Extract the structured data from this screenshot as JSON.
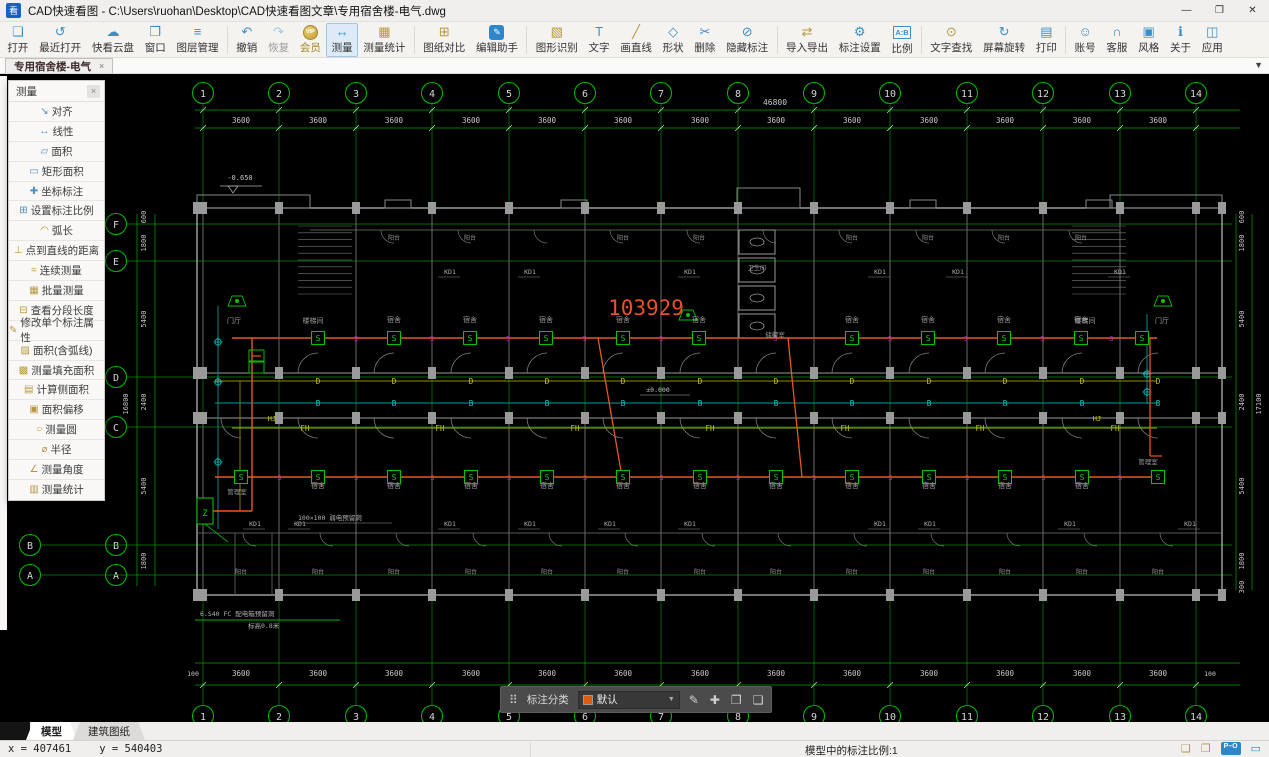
{
  "window": {
    "title": "CAD快速看图 - C:\\Users\\ruohan\\Desktop\\CAD快速看图文章\\专用宿舍楼-电气.dwg",
    "logo_glyph": "看",
    "minimize_glyph": "—",
    "restore_glyph": "❐",
    "close_glyph": "✕"
  },
  "toolbar": {
    "groups": [
      {
        "items": [
          {
            "name": "open",
            "label": "打开",
            "icon": "❏",
            "style": "blue"
          },
          {
            "name": "recent-open",
            "label": "最近打开",
            "icon": "↺",
            "style": "blue"
          },
          {
            "name": "cloud-drive",
            "label": "快看云盘",
            "icon": "☁",
            "style": "blue"
          },
          {
            "name": "window",
            "label": "窗口",
            "icon": "❒",
            "style": "blue"
          },
          {
            "name": "layer-manager",
            "label": "图层管理",
            "icon": "≡",
            "style": "blue"
          }
        ]
      },
      {
        "items": [
          {
            "name": "undo",
            "label": "撤销",
            "icon": "↶",
            "style": "blue"
          },
          {
            "name": "redo",
            "label": "恢复",
            "icon": "↷",
            "style": "blue",
            "disabled": true
          },
          {
            "name": "vip-member",
            "label": "会员",
            "icon": "VIP",
            "style": "vip"
          },
          {
            "name": "measure",
            "label": "测量",
            "icon": "↔",
            "style": "blue",
            "active": true
          },
          {
            "name": "measure-stats",
            "label": "测量统计",
            "icon": "▦",
            "style": "gold"
          }
        ]
      },
      {
        "items": [
          {
            "name": "drawing-compare",
            "label": "图纸对比",
            "icon": "⊞",
            "style": "gold"
          },
          {
            "name": "edit-assistant",
            "label": "编辑助手",
            "icon": "✎",
            "style": "badge"
          }
        ]
      },
      {
        "items": [
          {
            "name": "shape-recognition",
            "label": "图形识别",
            "icon": "▧",
            "style": "gold"
          },
          {
            "name": "text",
            "label": "文字",
            "icon": "T",
            "style": "blue"
          },
          {
            "name": "draw-line",
            "label": "画直线",
            "icon": "╱",
            "style": "gold"
          },
          {
            "name": "shapes",
            "label": "形状",
            "icon": "◇",
            "style": "blue"
          },
          {
            "name": "delete",
            "label": "删除",
            "icon": "✂",
            "style": "blue"
          },
          {
            "name": "hide-annotation",
            "label": "隐藏标注",
            "icon": "⊘",
            "style": "blue"
          }
        ]
      },
      {
        "items": [
          {
            "name": "import-export",
            "label": "导入导出",
            "icon": "⇄",
            "style": "gold"
          },
          {
            "name": "annotation-settings",
            "label": "标注设置",
            "icon": "⚙",
            "style": "blue"
          },
          {
            "name": "scale",
            "label": "比例",
            "icon": "A:B",
            "style": "ab"
          }
        ]
      },
      {
        "items": [
          {
            "name": "text-search",
            "label": "文字查找",
            "icon": "⊙",
            "style": "gold"
          },
          {
            "name": "screen-rotate",
            "label": "屏幕旋转",
            "icon": "↻",
            "style": "blue"
          },
          {
            "name": "print",
            "label": "打印",
            "icon": "▤",
            "style": "blue"
          }
        ]
      },
      {
        "items": [
          {
            "name": "account",
            "label": "账号",
            "icon": "☺",
            "style": "blue"
          },
          {
            "name": "customer-service",
            "label": "客服",
            "icon": "∩",
            "style": "blue"
          },
          {
            "name": "style",
            "label": "风格",
            "icon": "▣",
            "style": "blue"
          },
          {
            "name": "about",
            "label": "关于",
            "icon": "ℹ",
            "style": "blue"
          },
          {
            "name": "apps",
            "label": "应用",
            "icon": "◫",
            "style": "blue"
          }
        ]
      }
    ]
  },
  "doc_tab": {
    "label": "专用宿舍楼-电气",
    "close_glyph": "×",
    "overflow_glyph": "▼"
  },
  "measure_panel": {
    "title": "测量",
    "close_glyph": "×",
    "items": [
      {
        "name": "align",
        "label": "对齐",
        "icon": "↘",
        "color": "blue"
      },
      {
        "name": "linear",
        "label": "线性",
        "icon": "↔",
        "color": "blue"
      },
      {
        "name": "area",
        "label": "面积",
        "icon": "▱",
        "color": "blue"
      },
      {
        "name": "rect-area",
        "label": "矩形面积",
        "icon": "▭",
        "color": "blue"
      },
      {
        "name": "coord-annotation",
        "label": "坐标标注",
        "icon": "✚",
        "color": "blue"
      },
      {
        "name": "set-annotation-scale",
        "label": "设置标注比例",
        "icon": "⊞",
        "color": "blue"
      },
      {
        "name": "arc-length",
        "label": "弧长",
        "icon": "◠",
        "color": "gold"
      },
      {
        "name": "point-to-line",
        "label": "点到直线的距离",
        "icon": "⊥",
        "color": "gold"
      },
      {
        "name": "continuous-measure",
        "label": "连续测量",
        "icon": "≈",
        "color": "gold"
      },
      {
        "name": "batch-measure",
        "label": "批量测量",
        "icon": "▦",
        "color": "gold"
      },
      {
        "name": "segment-length",
        "label": "查看分段长度",
        "icon": "⊟",
        "color": "gold"
      },
      {
        "name": "edit-single-annotation",
        "label": "修改单个标注属性",
        "icon": "✎",
        "color": "gold"
      },
      {
        "name": "area-with-arc",
        "label": "面积(含弧线)",
        "icon": "▨",
        "color": "gold"
      },
      {
        "name": "fill-area",
        "label": "测量填充面积",
        "icon": "▩",
        "color": "gold"
      },
      {
        "name": "side-area",
        "label": "计算侧面积",
        "icon": "▤",
        "color": "gold"
      },
      {
        "name": "area-offset",
        "label": "面积偏移",
        "icon": "▣",
        "color": "gold"
      },
      {
        "name": "measure-circle",
        "label": "测量圆",
        "icon": "○",
        "color": "gold"
      },
      {
        "name": "radius",
        "label": "半径",
        "icon": "⌀",
        "color": "gold"
      },
      {
        "name": "measure-angle",
        "label": "测量角度",
        "icon": "∠",
        "color": "gold"
      },
      {
        "name": "measure-stats",
        "label": "测量统计",
        "icon": "▥",
        "color": "gold"
      }
    ]
  },
  "anno_toolbar": {
    "grid_icon": "⠿",
    "label": "标注分类",
    "selected": "默认",
    "swatch_color": "#e05a10",
    "caret": "▼",
    "icons": [
      {
        "name": "edit-annotation-icon",
        "glyph": "✎"
      },
      {
        "name": "move-annotation-icon",
        "glyph": "✚"
      },
      {
        "name": "copy-annotation-icon",
        "glyph": "❐"
      },
      {
        "name": "paste-annotation-icon",
        "glyph": "❏"
      }
    ]
  },
  "sheet_tabs": {
    "tabs": [
      {
        "name": "model",
        "label": "模型",
        "active": true
      },
      {
        "name": "arch-sheet",
        "label": "建筑图纸",
        "active": false
      }
    ]
  },
  "status_bar": {
    "coord_x": "x = 407461",
    "coord_y": "y = 540403",
    "scale_text": "模型中的标注比例:1",
    "po_badge": "P–O",
    "icons": [
      {
        "name": "note-icon",
        "glyph": "❏",
        "color": "gold"
      },
      {
        "name": "share-icon",
        "glyph": "❐",
        "color": "gold"
      }
    ],
    "monitor_glyph": "▭"
  },
  "drawing": {
    "axis_numbers": [
      "1",
      "2",
      "3",
      "4",
      "5",
      "6",
      "7",
      "8",
      "9",
      "10",
      "11",
      "12",
      "13",
      "14"
    ],
    "axis_letters": [
      "F",
      "E",
      "D",
      "C",
      "B",
      "A"
    ],
    "edge_letters": [
      "B",
      "A"
    ],
    "bay_dim": "3600",
    "total_top": "46800",
    "end_dim": "100",
    "left_dims": [
      "600",
      "1800",
      "5400",
      "2400",
      "5400",
      "1800"
    ],
    "left_total": "16800",
    "right_dims": [
      "600",
      "1800",
      "5400",
      "2400",
      "5400",
      "1800",
      "300"
    ],
    "right_total": "17100",
    "big_text": "103929",
    "elevation": "-0.650",
    "level": "±0.000",
    "labels": {
      "s": "S",
      "b": "B",
      "d": "D",
      "fh": "FH",
      "hj": "HJ",
      "kd": "KD1",
      "z": "Z"
    },
    "rooms": {
      "dorm": "宿舍",
      "balcony": "阳台",
      "stair": "楼梯间",
      "hall": "门厅",
      "storage": "储藏室",
      "manage": "管理室",
      "toilet": "卫生间"
    },
    "notes": [
      "6.S40 FC 配电箱预留洞",
      "标高0.8米",
      "100×100 弱电预留洞"
    ],
    "colors": {
      "grid": "#00a400",
      "bubble": "#00b400",
      "text": "#c8c8c8",
      "wall": "#8a8a8a",
      "column": "#9a9a9a",
      "wire": "#e8581c",
      "big_text": "#e8502a",
      "yellow_line": "#909000",
      "yellow_text": "#c8c800",
      "cyan_line": "#009c9c",
      "cyan_text": "#00d0d0",
      "magenta": "#cc2acc",
      "switch": "#00c000",
      "room_text": "#9a9a9a",
      "dim_note": "#b0b0b0"
    }
  }
}
